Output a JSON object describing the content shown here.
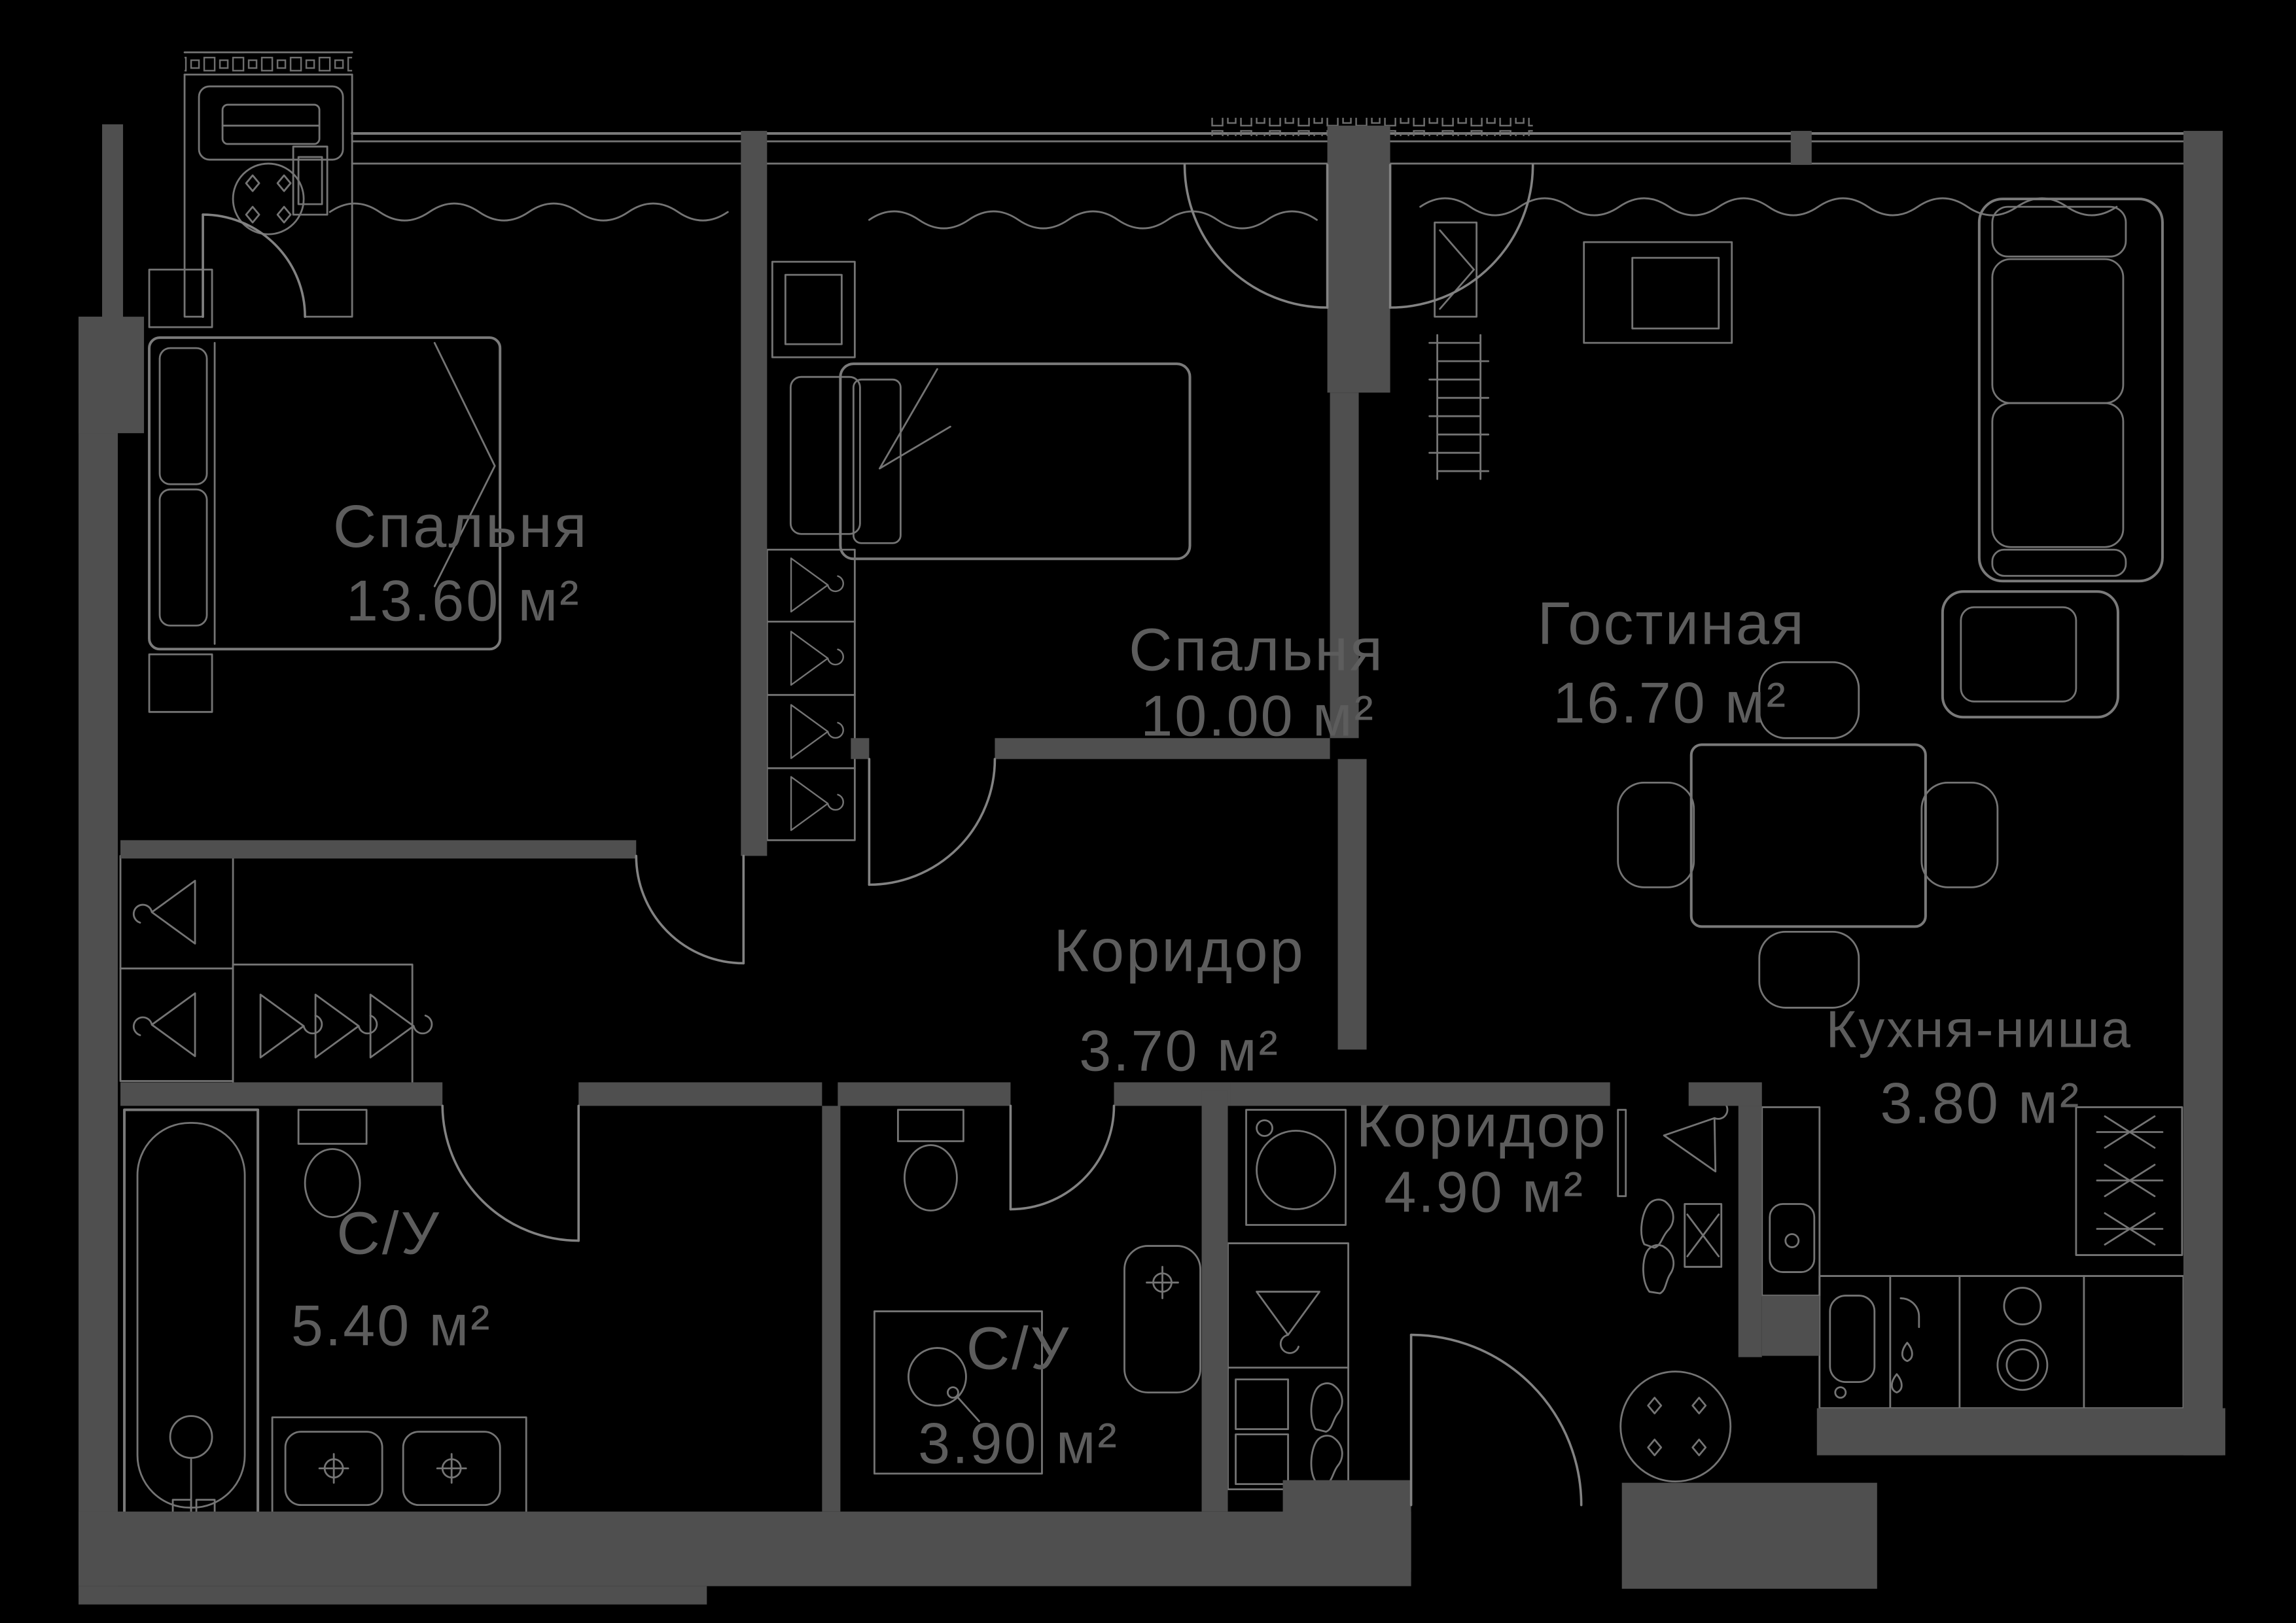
{
  "meta": {
    "type": "apartment-floor-plan",
    "language": "ru"
  },
  "palette": {
    "background": "#000000",
    "walls": "#4f4f4f",
    "furniture_lines": "#7a7a7a",
    "label_text": "#5d5d5d"
  },
  "rooms": [
    {
      "id": "bedroom-1",
      "name": "Спальня",
      "area": "13.60 м²"
    },
    {
      "id": "bedroom-2",
      "name": "Спальня",
      "area": "10.00 м²"
    },
    {
      "id": "living-room",
      "name": "Гостиная",
      "area": "16.70 м²"
    },
    {
      "id": "corridor-1",
      "name": "Коридор",
      "area": "3.70 м²"
    },
    {
      "id": "corridor-2",
      "name": "Коридор",
      "area": "4.90 м²"
    },
    {
      "id": "kitchen-niche",
      "name": "Кухня-ниша",
      "area": "3.80 м²"
    },
    {
      "id": "bathroom-1",
      "name": "С/У",
      "area": "5.40 м²"
    },
    {
      "id": "bathroom-2",
      "name": "С/У",
      "area": "3.90 м²"
    }
  ]
}
